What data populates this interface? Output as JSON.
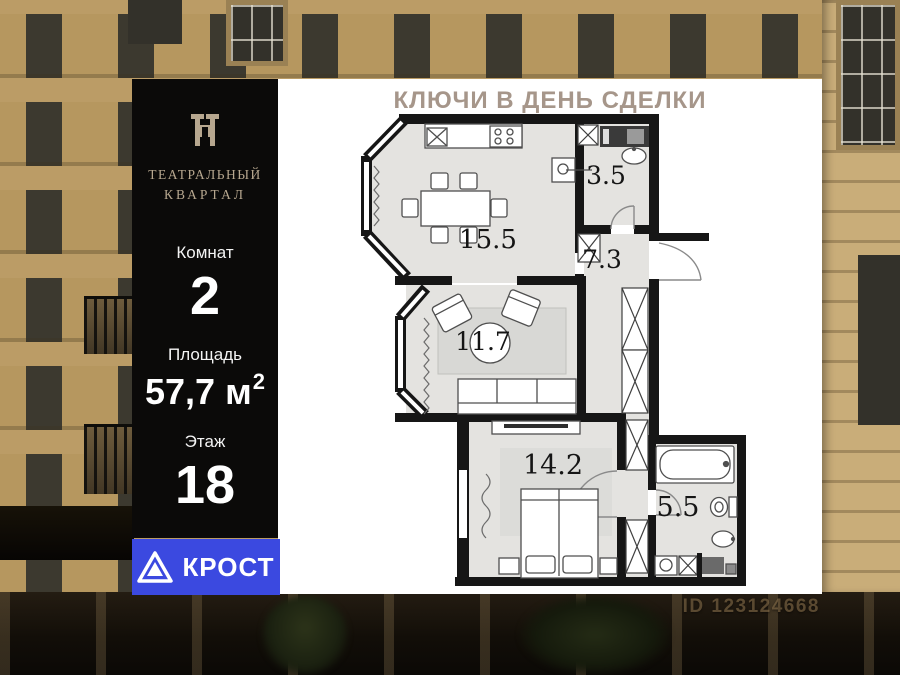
{
  "promo": {
    "title": "КЛЮЧИ В ДЕНЬ СДЕЛКИ"
  },
  "brand": {
    "project_line1": "ТЕАТРАЛЬНЫЙ",
    "project_line2": "КВАРТАЛ",
    "developer": "КРОСТ"
  },
  "specs": {
    "rooms_label": "Комнат",
    "rooms_value": "2",
    "area_label": "Площадь",
    "area_value": "57,7 м",
    "area_superscript": "2",
    "floor_label": "Этаж",
    "floor_value": "18"
  },
  "floorplan": {
    "rooms": [
      {
        "name": "kitchen-dining",
        "area": "15.5"
      },
      {
        "name": "guest-bathroom",
        "area": "3.5"
      },
      {
        "name": "hallway",
        "area": "7.3"
      },
      {
        "name": "living-room",
        "area": "11.7"
      },
      {
        "name": "bedroom",
        "area": "14.2"
      },
      {
        "name": "bathroom",
        "area": "5.5"
      }
    ]
  },
  "watermark": {
    "id_text": "ID 123124668"
  },
  "colors": {
    "accent_blue": "#3b49e0",
    "brand_beige": "#b7a78f",
    "promo_text": "#a6968a",
    "wall_black": "#161616",
    "floor_gray": "#e4e3e0",
    "panel_black": "#0b0a09"
  }
}
